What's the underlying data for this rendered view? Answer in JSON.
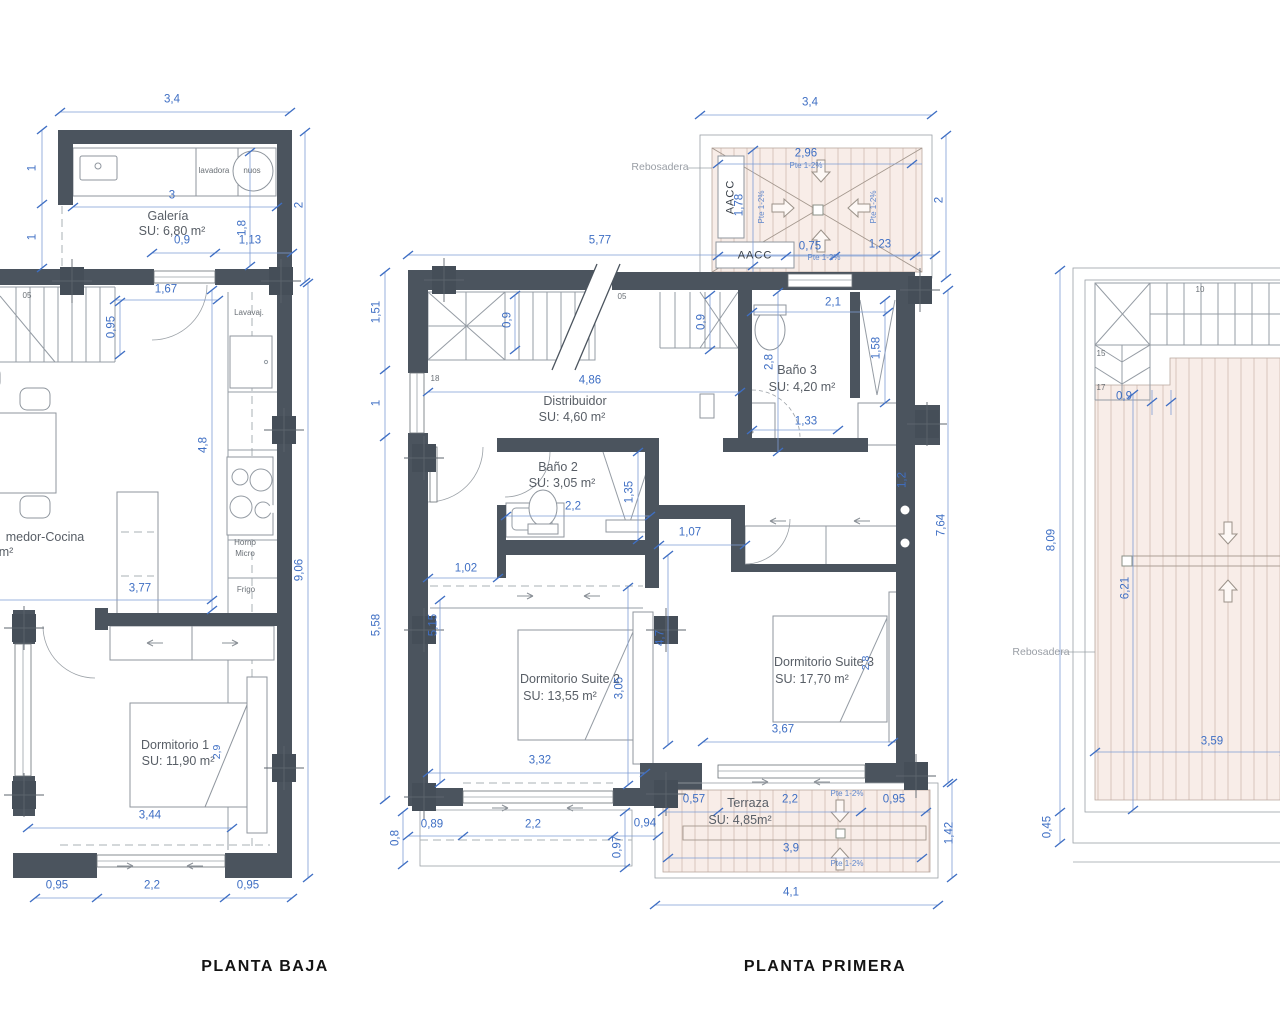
{
  "pb": {
    "title": "PLANTA BAJA",
    "room_galeria": "Galería",
    "area_galeria": "SU: 6,80 m²",
    "lavadora": "lavadora",
    "nuos": "nuos",
    "lavavajillas": "Lavavaj.",
    "horno": "Horno",
    "micro": "Micro",
    "frigo": "Frigo",
    "room_comedor": "medor-Cocina",
    "area_comedor": "m²",
    "room_dorm1": "Dormitorio 1",
    "area_dorm1": "SU: 11,90 m²",
    "step": "05",
    "d34": "3,4",
    "d3": "3",
    "d18": "1,8",
    "d2": "2",
    "d1a": "1",
    "d1b": "1",
    "d09": "0,9",
    "d113": "1,13",
    "d167": "1,67",
    "d095": "0,95",
    "d48": "4,8",
    "d377": "3,77",
    "d906": "9,06",
    "d344": "3,44",
    "d29": "2,9",
    "db095a": "0,95",
    "db22": "2,2",
    "db095b": "0,95"
  },
  "pp": {
    "title": "PLANTA PRIMERA",
    "rebosadera": "Rebosadera",
    "aacc_v": "AACC",
    "aacc_h": "AACC",
    "d34": "3,4",
    "d2": "2",
    "d296": "2,96",
    "d178": "1,78",
    "pte_a": "Pte 1-2%",
    "pte_b": "Pte 1-2%",
    "pte_c": "Pte 1-2%",
    "pte_d": "Pte 1-2%",
    "d075": "0,75",
    "d123": "1,23",
    "d577": "5,77",
    "step05": "05",
    "step18": "18",
    "d09a": "0,9",
    "d09b": "0,9",
    "d151": "1,51",
    "d1": "1",
    "d558": "5,58",
    "d486": "4,86",
    "room_distribuidor": "Distribuidor",
    "area_distribuidor": "SU: 4,60 m²",
    "room_bano2": "Baño 2",
    "area_bano2": "SU: 3,05 m²",
    "d22b": "2,2",
    "d135": "1,35",
    "room_bano3": "Baño 3",
    "area_bano3": "SU: 4,20 m²",
    "d21": "2,1",
    "d28a": "2,8",
    "d133": "1,33",
    "d158": "1,58",
    "d102": "1,02",
    "d515": "5,15",
    "d107": "1,07",
    "d47": "4,7",
    "d12": "1,2",
    "room_suite2": "Dormitorio Suite 2",
    "area_suite2": "SU: 13,55 m²",
    "d305": "3,05",
    "d332": "3,32",
    "room_suite3": "Dormitorio Suite 3",
    "area_suite3": "SU: 17,70 m²",
    "d28b": "2,8",
    "d367": "3,67",
    "d764": "7,64",
    "d089": "0,89",
    "d22c": "2,2",
    "d094": "0,94",
    "d097": "0,97",
    "d08": "0,8",
    "room_terraza": "Terraza",
    "area_terraza": "SU: 4,85m²",
    "d057": "0,57",
    "d22d": "2,2",
    "d095": "0,95",
    "d39": "3,9",
    "d41": "4,1",
    "d142": "1,42",
    "pte_e": "Pte 1-2%",
    "pte_f": "Pte 1-2%"
  },
  "sol": {
    "s10": "10",
    "s15": "15",
    "s17": "17",
    "d09": "0,9",
    "rebosadera": "Rebosadera",
    "d809": "8,09",
    "d621": "6,21",
    "d359": "3,59",
    "d045": "0,45"
  }
}
